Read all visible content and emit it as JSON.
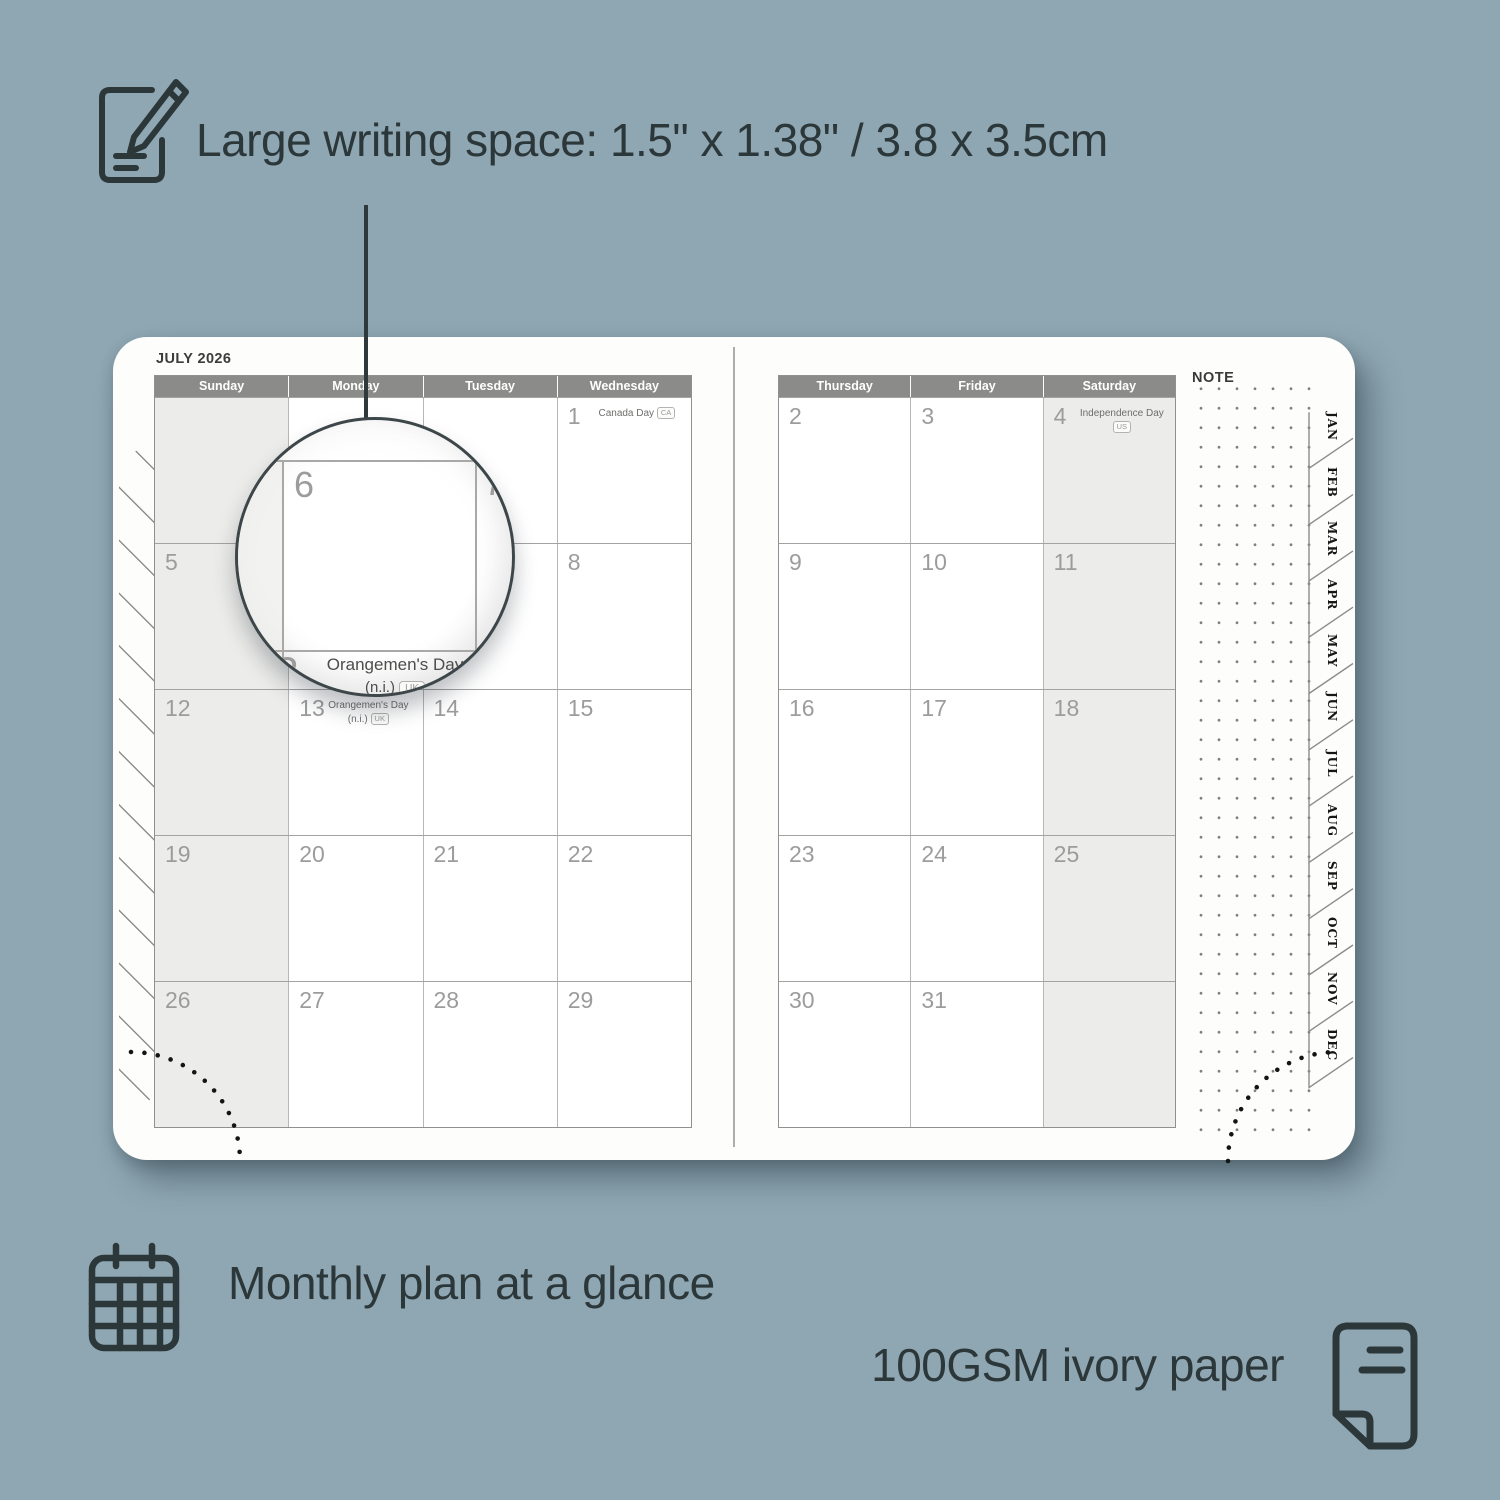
{
  "colors": {
    "background": "#8fa7b3",
    "ink": "#2c373a",
    "header_bar": "#8b8b89",
    "shaded_cell": "#ececea",
    "day_number": "#9c9c9c"
  },
  "annotations": {
    "top": {
      "icon": "notepad-pencil-icon",
      "text": "Large writing space: 1.5\" x 1.38\" / 3.8 x 3.5cm"
    },
    "bottom_left": {
      "icon": "calendar-grid-icon",
      "text": "Monthly plan at a glance"
    },
    "bottom_right": {
      "icon": "paper-page-icon",
      "text": "100GSM ivory paper"
    }
  },
  "planner": {
    "month_title": "JULY 2026",
    "note_label": "NOTE",
    "month_tabs": [
      "JAN",
      "FEB",
      "MAR",
      "APR",
      "MAY",
      "JUN",
      "JUL",
      "AUG",
      "SEP",
      "OCT",
      "NOV",
      "DEC"
    ],
    "left_page": {
      "weekday_headers": [
        "Sunday",
        "Monday",
        "Tuesday",
        "Wednesday"
      ],
      "shaded_column": 0,
      "weeks": [
        [
          {
            "day": ""
          },
          {
            "day": ""
          },
          {
            "day": ""
          },
          {
            "day": "1",
            "event_lines": [
              "Canada Day"
            ],
            "badge": "CA"
          }
        ],
        [
          {
            "day": "5"
          },
          {
            "day": "6"
          },
          {
            "day": "7"
          },
          {
            "day": "8"
          }
        ],
        [
          {
            "day": "12"
          },
          {
            "day": "13",
            "event_lines": [
              "Orangemen's Day",
              "(n.i.)"
            ],
            "badge": "UK"
          },
          {
            "day": "14"
          },
          {
            "day": "15"
          }
        ],
        [
          {
            "day": "19"
          },
          {
            "day": "20"
          },
          {
            "day": "21"
          },
          {
            "day": "22"
          }
        ],
        [
          {
            "day": "26"
          },
          {
            "day": "27"
          },
          {
            "day": "28"
          },
          {
            "day": "29"
          }
        ]
      ]
    },
    "right_page": {
      "weekday_headers": [
        "Thursday",
        "Friday",
        "Saturday"
      ],
      "shaded_column": 2,
      "weeks": [
        [
          {
            "day": "2"
          },
          {
            "day": "3"
          },
          {
            "day": "4",
            "event_lines": [
              "Independence Day"
            ],
            "badge": "US"
          }
        ],
        [
          {
            "day": "9"
          },
          {
            "day": "10"
          },
          {
            "day": "11"
          }
        ],
        [
          {
            "day": "16"
          },
          {
            "day": "17"
          },
          {
            "day": "18"
          }
        ],
        [
          {
            "day": "23"
          },
          {
            "day": "24"
          },
          {
            "day": "25"
          }
        ],
        [
          {
            "day": "30"
          },
          {
            "day": "31"
          },
          {
            "day": ""
          }
        ]
      ]
    },
    "magnifier": {
      "day_top_left": "6",
      "day_top_right": "7",
      "day_bottom": "13",
      "event_line1": "Orangemen's Day",
      "event_line2": "(n.i.)",
      "badge": "UK"
    }
  }
}
